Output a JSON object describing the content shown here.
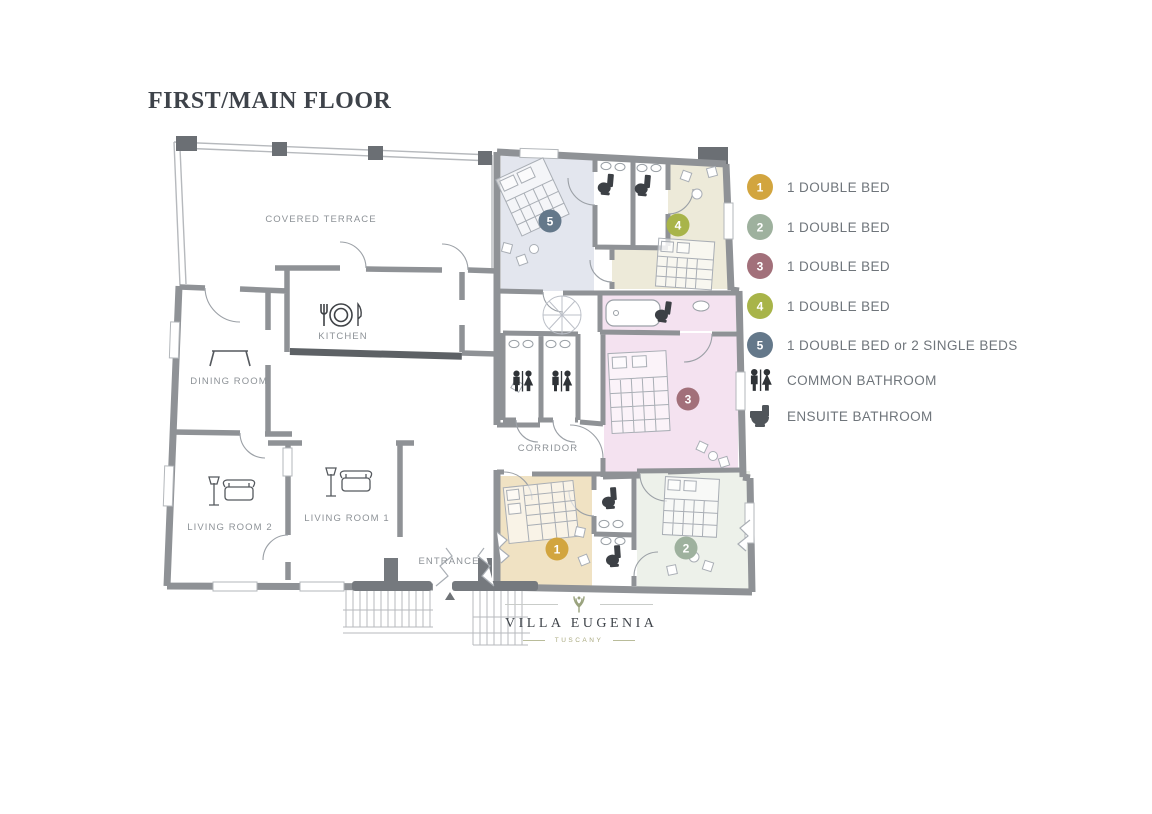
{
  "title": "FIRST/MAIN FLOOR",
  "plan": {
    "labels": {
      "terrace": "COVERED TERRACE",
      "kitchen": "KITCHEN",
      "dining": "DINING ROOM",
      "living2": "LIVING ROOM 2",
      "living1": "LIVING ROOM 1",
      "corridor": "CORRIDOR",
      "entrance": "ENTRANCE"
    },
    "fills": {
      "r1": "#f0e2c3",
      "r2": "#edf1ea",
      "r3": "#f4e2f0",
      "r4": "#edead9",
      "r5": "#e3e6ee",
      "bath3": "#f4e2f0"
    }
  },
  "legend": {
    "items": [
      {
        "number": "1",
        "color": "#d2a53f",
        "label": "1 DOUBLE BED"
      },
      {
        "number": "2",
        "color": "#9eb19e",
        "label": "1 DOUBLE BED"
      },
      {
        "number": "3",
        "color": "#a2707a",
        "label": "1 DOUBLE BED"
      },
      {
        "number": "4",
        "color": "#a8b449",
        "label": "1 DOUBLE BED"
      },
      {
        "number": "5",
        "color": "#64788a",
        "label": "1 DOUBLE BED or 2 SINGLE BEDS"
      }
    ],
    "bathrooms": [
      {
        "icon": "wc-people-icon",
        "label": "COMMON BATHROOM"
      },
      {
        "icon": "toilet-icon",
        "label": "ENSUITE BATHROOM"
      }
    ]
  },
  "logo": {
    "name": "VILLA EUGENIA",
    "subtitle": "TUSCANY"
  }
}
